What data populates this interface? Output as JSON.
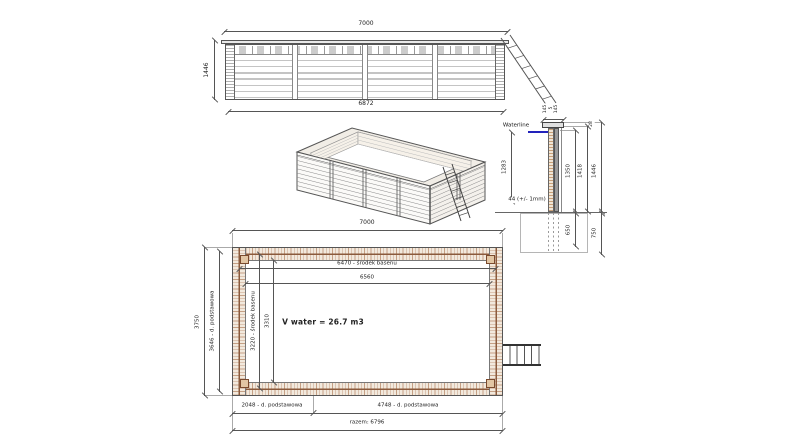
{
  "meta": {
    "drawing_type": "wooden pool technical drawing"
  },
  "colors": {
    "line": "#555555",
    "text": "#222222",
    "wood_fill": "#f2e9dd",
    "wood_hatch": "#a0643c",
    "wood_center_line": "#8b5a3c",
    "waterline_blue": "#2222bb"
  },
  "elevation_view": {
    "dim_width_top": "7000",
    "dim_height_left": "1446",
    "dim_width_bottom": "6872"
  },
  "section_view": {
    "waterline_label": "Waterline",
    "dim_cap_left": "145",
    "dim_cap_gap": "5",
    "dim_cap_right": "145",
    "dim_offset_top": "28",
    "dim_water_depth": "1283",
    "dim_height_inner": "1350",
    "dim_height_mid": "1418",
    "dim_height_outer": "1446",
    "dim_plank_note": "44 (+/- 1mm)",
    "dim_footing_inner": "650",
    "dim_footing_outer": "750"
  },
  "plan_view": {
    "dim_width_top": "7000",
    "dim_inner_center_h": "6470 - środek basenu",
    "dim_inner_h": "6560",
    "dim_outer_v": "3750",
    "dim_base_v": "3646 - d. podstawowa",
    "dim_inner_center_v": "3220 - środek basenu",
    "dim_inner_v": "3310",
    "volume_note": "V water = 26.7 m3",
    "dim_base_left": "2048 - d. podstawowa",
    "dim_base_right": "4748 - d. podstawowa",
    "dim_total": "razem: 6796"
  }
}
